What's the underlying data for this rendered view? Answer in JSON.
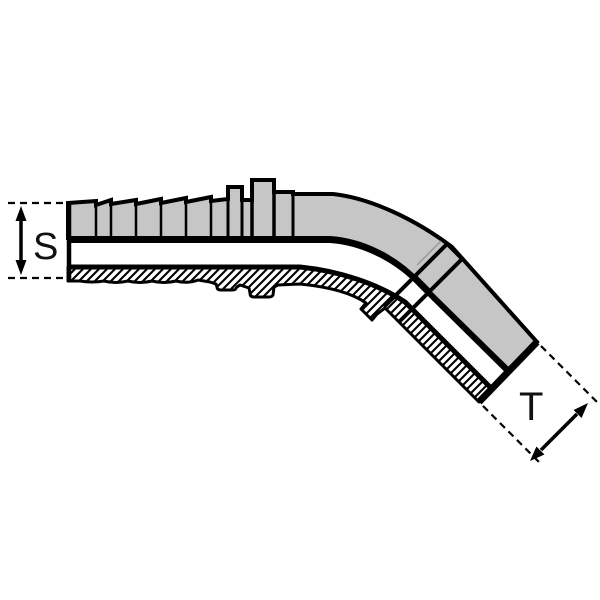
{
  "diagram": {
    "type": "technical-section-drawing",
    "subject": "45-degree elbow hose fitting, half-section view",
    "labels": {
      "s": "S",
      "t": "T"
    },
    "dimensions": [
      {
        "id": "S",
        "orientation": "vertical",
        "marker": "double-headed arrow between dashed extension lines at hose-tail end"
      },
      {
        "id": "T",
        "orientation": "diagonal-45deg",
        "marker": "double-headed arrow between dashed extension lines at outlet end"
      }
    ],
    "colors": {
      "body_fill": "#c6c6c6",
      "outline": "#000000",
      "background": "#ffffff",
      "faint_line": "#9a9a9a"
    }
  }
}
